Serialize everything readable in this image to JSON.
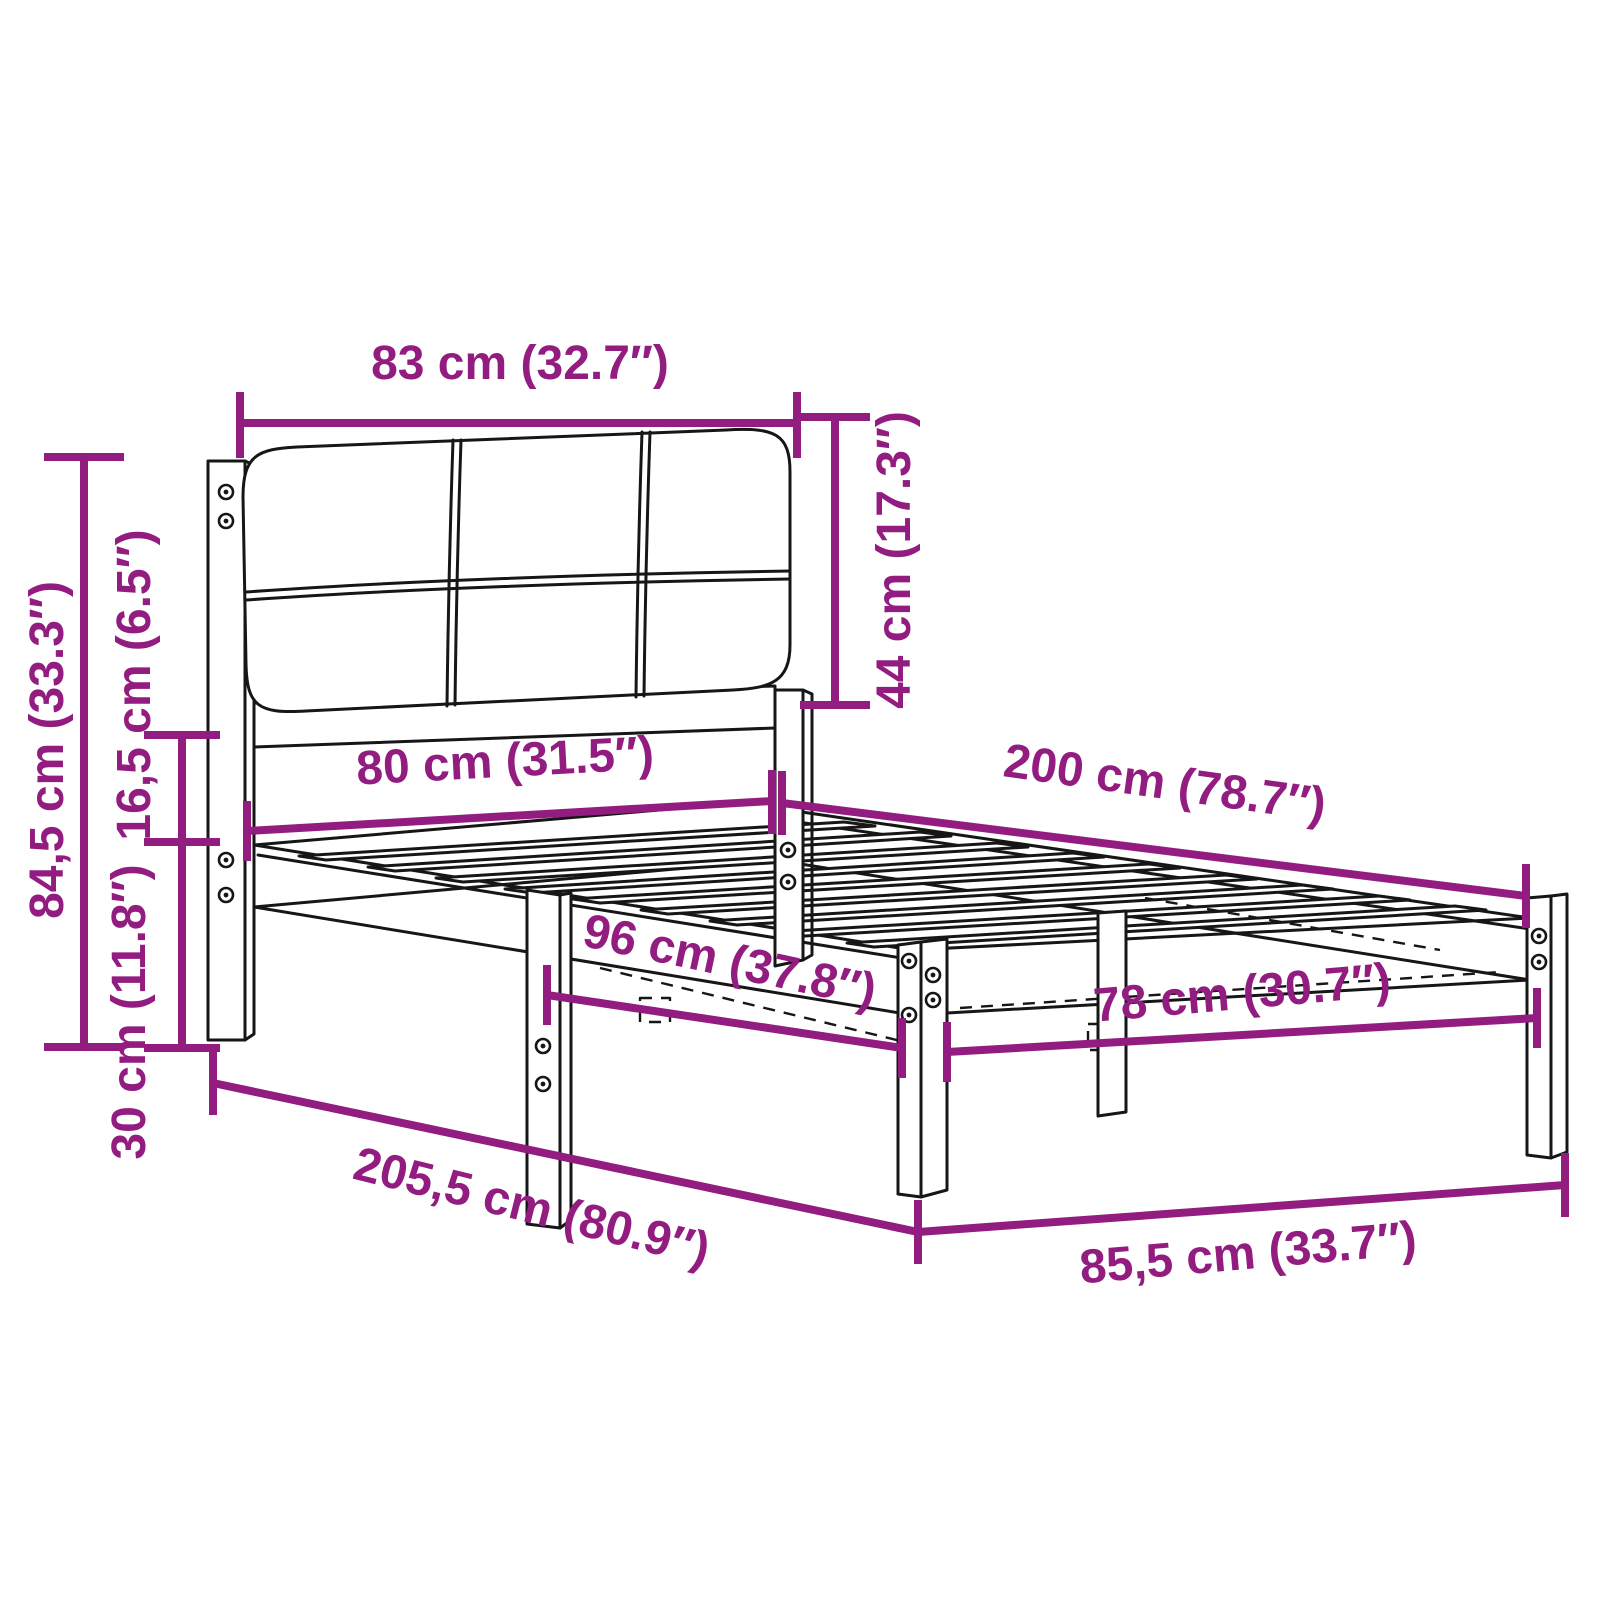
{
  "diagram": {
    "type": "product-dimension-diagram",
    "subject": "bed-frame-with-upholstered-headboard-and-slats",
    "background_color": "#ffffff",
    "accent_color": "#921c80",
    "line_color": "#161616",
    "units": [
      "cm",
      "in"
    ],
    "dimensions": [
      {
        "id": "headboard-width",
        "text": "83 cm (32.7″)",
        "cm": "83",
        "in": "32.7",
        "line": [
          240,
          423,
          797,
          423
        ],
        "ticks": [
          [
            240,
            392,
            240,
            458
          ],
          [
            797,
            392,
            797,
            458
          ]
        ],
        "label": {
          "x": 520,
          "y": 362,
          "rotate": 0
        }
      },
      {
        "id": "headboard-height",
        "text": "44 cm (17.3″)",
        "cm": "44",
        "in": "17.3",
        "line": [
          835,
          417,
          835,
          705
        ],
        "ticks": [
          [
            800,
            417,
            870,
            417
          ],
          [
            800,
            705,
            870,
            705
          ]
        ],
        "label": {
          "x": 893,
          "y": 560,
          "rotate": -90
        }
      },
      {
        "id": "total-height",
        "text": "84,5 cm (33.3″)",
        "cm": "84,5",
        "in": "33.3",
        "line": [
          84,
          457,
          84,
          1047
        ],
        "ticks": [
          [
            44,
            457,
            124,
            457
          ],
          [
            44,
            1047,
            124,
            1047
          ]
        ],
        "label": {
          "x": 46,
          "y": 750,
          "rotate": -90
        }
      },
      {
        "id": "rail-gap-height",
        "text": "16,5 cm (6.5″)",
        "cm": "16,5",
        "in": "6.5",
        "line": [
          182,
          735,
          182,
          842
        ],
        "ticks": [
          [
            144,
            735,
            220,
            735
          ],
          [
            144,
            842,
            220,
            842
          ]
        ],
        "label": {
          "x": 133,
          "y": 685,
          "rotate": -90
        }
      },
      {
        "id": "leg-height",
        "text": "30 cm (11.8″)",
        "cm": "30",
        "in": "11.8",
        "line": [
          182,
          842,
          182,
          1048
        ],
        "ticks": [
          [
            144,
            1048,
            220,
            1048
          ]
        ],
        "label": {
          "x": 128,
          "y": 1012,
          "rotate": -90
        }
      },
      {
        "id": "inner-width-head",
        "text": "80 cm (31.5″)",
        "cm": "80",
        "in": "31.5",
        "line": [
          247,
          831,
          772,
          801
        ],
        "ticks": [
          [
            247,
            801,
            247,
            861
          ],
          [
            772,
            770,
            772,
            834
          ]
        ],
        "label": {
          "x": 505,
          "y": 760,
          "rotate": -3
        }
      },
      {
        "id": "inner-length",
        "text": "200 cm (78.7″)",
        "cm": "200",
        "in": "78.7",
        "line": [
          782,
          803,
          1526,
          896
        ],
        "ticks": [
          [
            782,
            771,
            782,
            835
          ],
          [
            1526,
            864,
            1526,
            928
          ]
        ],
        "label": {
          "x": 1165,
          "y": 782,
          "rotate": 8
        }
      },
      {
        "id": "support-spacing",
        "text": "96 cm (37.8″)",
        "cm": "96",
        "in": "37.8",
        "line": [
          547,
          995,
          902,
          1048
        ],
        "ticks": [
          [
            547,
            965,
            547,
            1025
          ],
          [
            902,
            1018,
            902,
            1078
          ]
        ],
        "label": {
          "x": 730,
          "y": 960,
          "rotate": 12
        }
      },
      {
        "id": "inner-width-foot",
        "text": "78 cm (30.7″)",
        "cm": "78",
        "in": "30.7",
        "line": [
          947,
          1052,
          1537,
          1018
        ],
        "ticks": [
          [
            947,
            1022,
            947,
            1082
          ],
          [
            1537,
            988,
            1537,
            1048
          ]
        ],
        "label": {
          "x": 1242,
          "y": 992,
          "rotate": -5
        }
      },
      {
        "id": "total-length",
        "text": "205,5 cm (80.9″)",
        "cm": "205,5",
        "in": "80.9",
        "line": [
          213,
          1083,
          918,
          1232
        ],
        "ticks": [
          [
            213,
            1051,
            213,
            1115
          ],
          [
            918,
            1200,
            918,
            1264
          ]
        ],
        "label": {
          "x": 532,
          "y": 1206,
          "rotate": 14
        }
      },
      {
        "id": "total-width",
        "text": "85,5 cm (33.7″)",
        "cm": "85,5",
        "in": "33.7",
        "line": [
          918,
          1232,
          1565,
          1185
        ],
        "ticks": [
          [
            918,
            1200,
            918,
            1264
          ],
          [
            1565,
            1153,
            1565,
            1217
          ]
        ],
        "label": {
          "x": 1248,
          "y": 1252,
          "rotate": -5
        }
      }
    ]
  }
}
